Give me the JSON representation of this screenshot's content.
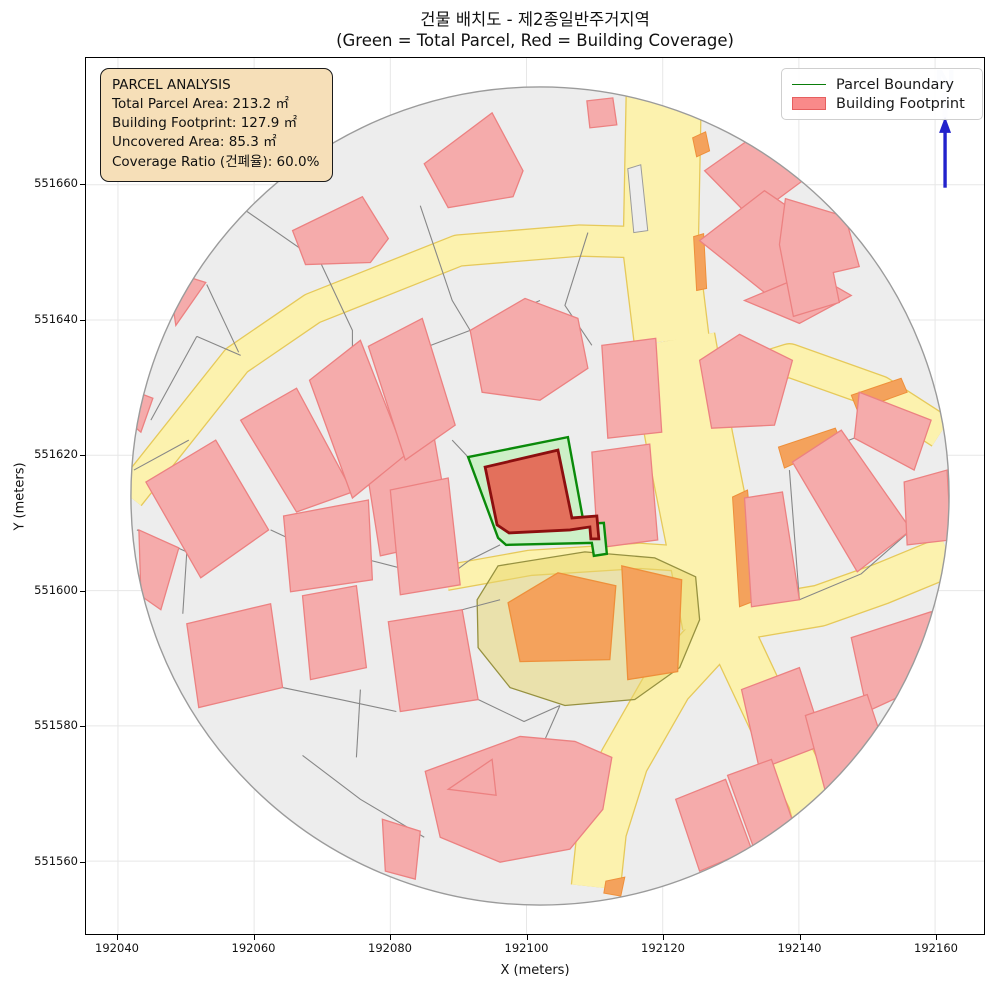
{
  "title": {
    "line1": "건물 배치도 - 제2종일반주거지역",
    "line2": "(Green = Total Parcel, Red = Building Coverage)"
  },
  "axes": {
    "xlabel": "X (meters)",
    "ylabel": "Y (meters)",
    "x_ticks": [
      {
        "label": "192040",
        "px": 117
      },
      {
        "label": "192060",
        "px": 253.5
      },
      {
        "label": "192080",
        "px": 390
      },
      {
        "label": "192100",
        "px": 526.5
      },
      {
        "label": "192120",
        "px": 663
      },
      {
        "label": "192140",
        "px": 799.5
      },
      {
        "label": "192160",
        "px": 936
      }
    ],
    "y_ticks": [
      {
        "label": "551660",
        "px": 184
      },
      {
        "label": "551640",
        "px": 319.6
      },
      {
        "label": "551620",
        "px": 455.2
      },
      {
        "label": "551600",
        "px": 590.8
      },
      {
        "label": "551580",
        "px": 726.4
      },
      {
        "label": "551560",
        "px": 862
      }
    ]
  },
  "info_box": {
    "title": "PARCEL ANALYSIS",
    "lines": [
      "Total Parcel Area: 213.2 ㎡",
      "Building Footprint: 127.9 ㎡",
      "Uncovered Area: 85.3 ㎡",
      "Coverage Ratio (건폐율): 60.0%"
    ]
  },
  "legend": {
    "items": [
      {
        "label": "Parcel Boundary",
        "type": "line"
      },
      {
        "label": "Building Footprint",
        "type": "patch"
      }
    ]
  },
  "north_label": "N",
  "map": {
    "colors": {
      "ground": "#ededed",
      "circle_edge": "#9b9b9b",
      "grid": "#e7e7e7",
      "road_fill": "#fcf2ae",
      "road_edge": "#e6c95a",
      "gray_line": "#878787",
      "building_fill": "#f5abab",
      "building_edge": "#ec8181",
      "orange_fill": "#f4a25c",
      "orange_edge": "#ee8f3a",
      "zone_fill": "#e8d56b",
      "zone_edge": "#969140",
      "parcel_fill": "#cdf0c8",
      "parcel_edge": "#0a8a0a",
      "footprint_fill": "#e3705c",
      "footprint_edge": "#8c0f0f",
      "north_blue": "#2222cc",
      "north_faint": "#aab0e8"
    },
    "circle": {
      "cx": 540,
      "cy": 496,
      "r": 410
    },
    "roads": [
      {
        "d": "M128,496 L236,360 L312,308 L458,250 L580,240 L652,242",
        "w": 30
      },
      {
        "d": "M664,95 L661,250 L672,340",
        "w": 74
      },
      {
        "d": "M672,340 L690,440 L706,520 L718,580 L726,622",
        "w": 86
      },
      {
        "d": "M726,622 L668,685 L624,762 L602,832 L596,888",
        "w": 48
      },
      {
        "d": "M726,622 L772,720 L812,800 L822,838",
        "w": 46
      },
      {
        "d": "M726,622 L820,606 L882,584 L950,556",
        "w": 40
      },
      {
        "d": "M688,392 L790,360 L880,392 L942,432",
        "w": 32
      },
      {
        "d": "M446,578 L530,563 L640,556 L700,560",
        "w": 24
      }
    ],
    "island": [
      [
        628,
        168
      ],
      [
        641,
        164
      ],
      [
        648,
        230
      ],
      [
        634,
        232
      ]
    ],
    "zone": [
      [
        498,
        566
      ],
      [
        585,
        552
      ],
      [
        655,
        558
      ],
      [
        696,
        577
      ],
      [
        700,
        620
      ],
      [
        680,
        668
      ],
      [
        635,
        700
      ],
      [
        565,
        706
      ],
      [
        510,
        688
      ],
      [
        478,
        648
      ],
      [
        477,
        600
      ]
    ],
    "gray_lines": [
      "M133,470 L188,440",
      "M150,420 L196,336",
      "M196,336 L240,355",
      "M206,284 L238,352",
      "M225,196 L320,262",
      "M320,262 L352,330 L352,385",
      "M420,205 L452,300 L470,330",
      "M470,330 L412,352",
      "M470,330 L540,300",
      "M588,232 L565,305 L592,345",
      "M452,440 L468,457",
      "M648,446 L656,540",
      "M500,545 L470,560 L446,578",
      "M368,560 L438,578",
      "M136,530 L186,552 L182,614",
      "M270,530 L330,558",
      "M282,688 L340,700 L396,712",
      "M302,756 L360,800 L424,838",
      "M360,690 L356,758",
      "M462,610 L500,600",
      "M420,620 L462,610",
      "M478,700 L524,722 L560,706",
      "M545,740 L560,706",
      "M790,470 L800,600",
      "M912,530 L862,574 L800,600",
      "M855,438 L793,462",
      "M868,712 L892,768",
      "M826,792 L800,832"
    ],
    "orange_strips": [
      [
        [
          693,
          137
        ],
        [
          706,
          131
        ],
        [
          710,
          150
        ],
        [
          697,
          156
        ]
      ],
      [
        [
          694,
          236
        ],
        [
          704,
          233
        ],
        [
          707,
          288
        ],
        [
          697,
          290
        ]
      ],
      [
        [
          779,
          447
        ],
        [
          836,
          428
        ],
        [
          842,
          442
        ],
        [
          785,
          468
        ]
      ],
      [
        [
          733,
          497
        ],
        [
          748,
          490
        ],
        [
          758,
          600
        ],
        [
          740,
          607
        ]
      ],
      [
        [
          852,
          395
        ],
        [
          902,
          378
        ],
        [
          908,
          392
        ],
        [
          858,
          410
        ]
      ],
      [
        [
          606,
          882
        ],
        [
          625,
          878
        ],
        [
          621,
          897
        ],
        [
          604,
          894
        ]
      ]
    ],
    "buildings": [
      [
        [
          424,
          163
        ],
        [
          492,
          112
        ],
        [
          523,
          170
        ],
        [
          513,
          196
        ],
        [
          448,
          207
        ]
      ],
      [
        [
          587,
          100
        ],
        [
          613,
          97
        ],
        [
          617,
          124
        ],
        [
          590,
          127
        ]
      ],
      [
        [
          705,
          170
        ],
        [
          762,
          130
        ],
        [
          810,
          175
        ],
        [
          752,
          218
        ]
      ],
      [
        [
          700,
          240
        ],
        [
          765,
          190
        ],
        [
          850,
          248
        ],
        [
          775,
          300
        ]
      ],
      [
        [
          745,
          300
        ],
        [
          812,
          272
        ],
        [
          852,
          295
        ],
        [
          800,
          323
        ]
      ],
      [
        [
          700,
          360
        ],
        [
          740,
          334
        ],
        [
          793,
          360
        ],
        [
          775,
          425
        ],
        [
          712,
          428
        ]
      ],
      [
        [
          786,
          198
        ],
        [
          846,
          216
        ],
        [
          860,
          266
        ],
        [
          834,
          272
        ],
        [
          840,
          302
        ],
        [
          794,
          316
        ],
        [
          780,
          244
        ]
      ],
      [
        [
          793,
          462
        ],
        [
          842,
          430
        ],
        [
          912,
          530
        ],
        [
          858,
          572
        ]
      ],
      [
        [
          860,
          392
        ],
        [
          932,
          420
        ],
        [
          915,
          470
        ],
        [
          855,
          438
        ]
      ],
      [
        [
          905,
          482
        ],
        [
          948,
          470
        ],
        [
          952,
          540
        ],
        [
          908,
          545
        ]
      ],
      [
        [
          745,
          498
        ],
        [
          783,
          492
        ],
        [
          800,
          600
        ],
        [
          752,
          607
        ]
      ],
      [
        [
          742,
          690
        ],
        [
          800,
          668
        ],
        [
          825,
          745
        ],
        [
          760,
          770
        ]
      ],
      [
        [
          676,
          800
        ],
        [
          726,
          780
        ],
        [
          752,
          850
        ],
        [
          700,
          872
        ]
      ],
      [
        [
          728,
          776
        ],
        [
          772,
          760
        ],
        [
          796,
          830
        ],
        [
          754,
          848
        ]
      ],
      [
        [
          852,
          638
        ],
        [
          932,
          612
        ],
        [
          948,
          675
        ],
        [
          868,
          712
        ]
      ],
      [
        [
          806,
          716
        ],
        [
          868,
          695
        ],
        [
          892,
          768
        ],
        [
          826,
          792
        ]
      ],
      [
        [
          795,
          842
        ],
        [
          820,
          832
        ],
        [
          824,
          856
        ],
        [
          800,
          862
        ]
      ],
      [
        [
          360,
          430
        ],
        [
          430,
          415
        ],
        [
          452,
          540
        ],
        [
          380,
          556
        ]
      ],
      [
        [
          390,
          490
        ],
        [
          448,
          478
        ],
        [
          460,
          585
        ],
        [
          400,
          595
        ]
      ],
      [
        [
          388,
          622
        ],
        [
          462,
          610
        ],
        [
          478,
          700
        ],
        [
          400,
          712
        ]
      ],
      [
        [
          592,
          452
        ],
        [
          650,
          444
        ],
        [
          658,
          540
        ],
        [
          598,
          548
        ]
      ],
      [
        [
          602,
          345
        ],
        [
          656,
          338
        ],
        [
          662,
          432
        ],
        [
          608,
          438
        ]
      ],
      [
        [
          470,
          330
        ],
        [
          525,
          298
        ],
        [
          578,
          318
        ],
        [
          588,
          368
        ],
        [
          540,
          400
        ],
        [
          482,
          392
        ]
      ],
      [
        [
          283,
          516
        ],
        [
          368,
          500
        ],
        [
          372,
          580
        ],
        [
          290,
          592
        ]
      ],
      [
        [
          425,
          772
        ],
        [
          520,
          737
        ],
        [
          575,
          742
        ],
        [
          612,
          758
        ],
        [
          603,
          810
        ],
        [
          570,
          850
        ],
        [
          500,
          863
        ],
        [
          440,
          838
        ]
      ],
      [
        [
          186,
          624
        ],
        [
          270,
          604
        ],
        [
          282,
          688
        ],
        [
          198,
          708
        ]
      ],
      [
        [
          302,
          596
        ],
        [
          356,
          586
        ],
        [
          366,
          668
        ],
        [
          310,
          680
        ]
      ],
      [
        [
          138,
          530
        ],
        [
          178,
          548
        ],
        [
          160,
          610
        ],
        [
          140,
          596
        ]
      ],
      [
        [
          382,
          820
        ],
        [
          420,
          832
        ],
        [
          415,
          880
        ],
        [
          385,
          872
        ]
      ],
      [
        [
          448,
          790
        ],
        [
          492,
          760
        ],
        [
          496,
          796
        ]
      ],
      [
        [
          131,
          390
        ],
        [
          152,
          398
        ],
        [
          140,
          432
        ],
        [
          128,
          422
        ]
      ],
      [
        [
          167,
          270
        ],
        [
          205,
          282
        ],
        [
          175,
          325
        ]
      ],
      [
        [
          292,
          230
        ],
        [
          362,
          196
        ],
        [
          388,
          238
        ],
        [
          370,
          262
        ],
        [
          305,
          264
        ]
      ],
      [
        [
          145,
          482
        ],
        [
          215,
          440
        ],
        [
          268,
          530
        ],
        [
          200,
          578
        ]
      ],
      [
        [
          240,
          420
        ],
        [
          296,
          388
        ],
        [
          352,
          492
        ],
        [
          296,
          512
        ]
      ],
      [
        [
          309,
          380
        ],
        [
          360,
          340
        ],
        [
          405,
          455
        ],
        [
          352,
          498
        ]
      ],
      [
        [
          368,
          346
        ],
        [
          422,
          318
        ],
        [
          455,
          425
        ],
        [
          405,
          460
        ]
      ]
    ],
    "orange_buildings": [
      [
        [
          508,
          603
        ],
        [
          558,
          573
        ],
        [
          616,
          586
        ],
        [
          610,
          660
        ],
        [
          520,
          662
        ]
      ],
      [
        [
          622,
          566
        ],
        [
          682,
          580
        ],
        [
          678,
          672
        ],
        [
          628,
          680
        ]
      ]
    ],
    "parcel": [
      [
        468,
        457
      ],
      [
        568,
        437
      ],
      [
        584,
        524
      ],
      [
        604,
        523
      ],
      [
        607,
        554
      ],
      [
        594,
        556
      ],
      [
        592,
        543
      ],
      [
        506,
        545
      ],
      [
        498,
        538
      ]
    ],
    "footprint": [
      [
        485,
        467
      ],
      [
        558,
        450
      ],
      [
        572,
        518
      ],
      [
        597,
        516
      ],
      [
        599,
        539
      ],
      [
        591,
        539
      ],
      [
        590,
        527
      ],
      [
        570,
        530
      ],
      [
        509,
        533
      ],
      [
        497,
        525
      ]
    ],
    "north": {
      "x": 946,
      "label_y": 88,
      "stem_top": 92,
      "stem_bottom": 120,
      "line_top": 124,
      "line_bottom": 187
    }
  }
}
